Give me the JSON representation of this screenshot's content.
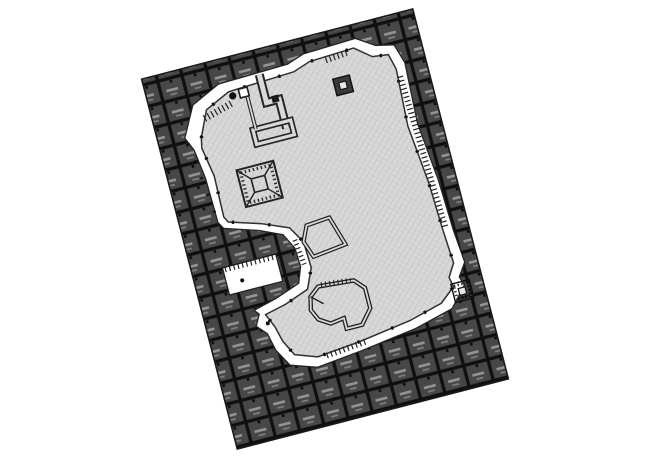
{
  "page": {
    "background": "#ffffff"
  },
  "drawing": {
    "kind": "rotated architectural site / excavation plan",
    "rotation_deg": -14.5,
    "colors": {
      "outline": "#1a1a1a",
      "stall_fill": "#474747",
      "stall_grid": "#0f0f0f",
      "stall_mark": "#949494",
      "stall_mark_dim": "#7d7d7d",
      "berm_fill": "#ffffff",
      "pit_fill": "#d9d9d9",
      "pit_hatch_line": "#c9c9c9",
      "detail_line": "#262626",
      "shape_core_fill": "#3a3a3a",
      "shape_core_hole": "#e9e9e9"
    }
  }
}
